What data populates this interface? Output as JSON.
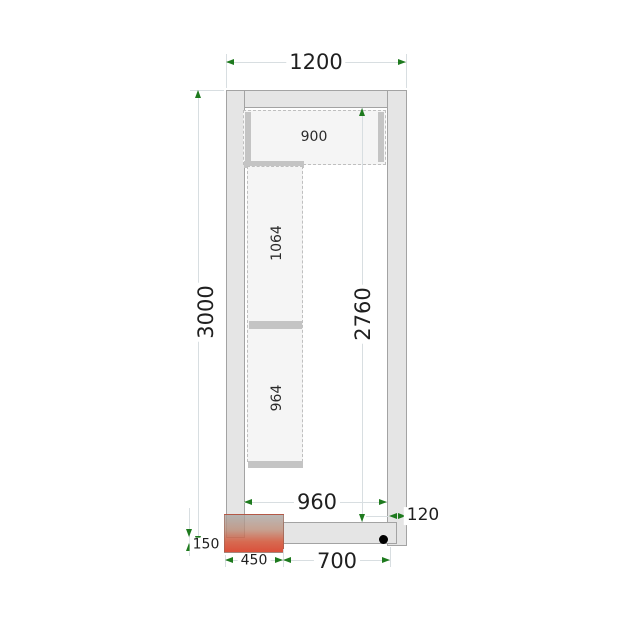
{
  "drawing": {
    "type": "cold-room-floor-plan",
    "dims": {
      "outer_width": "1200",
      "outer_height": "3000",
      "inner_height": "2760",
      "inner_width": "960",
      "wall_thickness": "120",
      "door_sill_depth": "150",
      "door_width": "450",
      "bottom_panel_width": "700"
    },
    "shelves": {
      "top_width": "900",
      "left_upper_length": "1064",
      "left_lower_length": "964"
    },
    "colors": {
      "wall_fill": "#e5e5e5",
      "wall_outline": "#a3a3a3",
      "shelf_fill": "#f5f5f5",
      "shelf_bar": "#c4c4c4",
      "dimension_line": "#d8dee1",
      "arrow_green": "#1e7a1e",
      "text": "#1f1f1f",
      "door_red": "#d84730",
      "marker_black": "#000000"
    }
  }
}
